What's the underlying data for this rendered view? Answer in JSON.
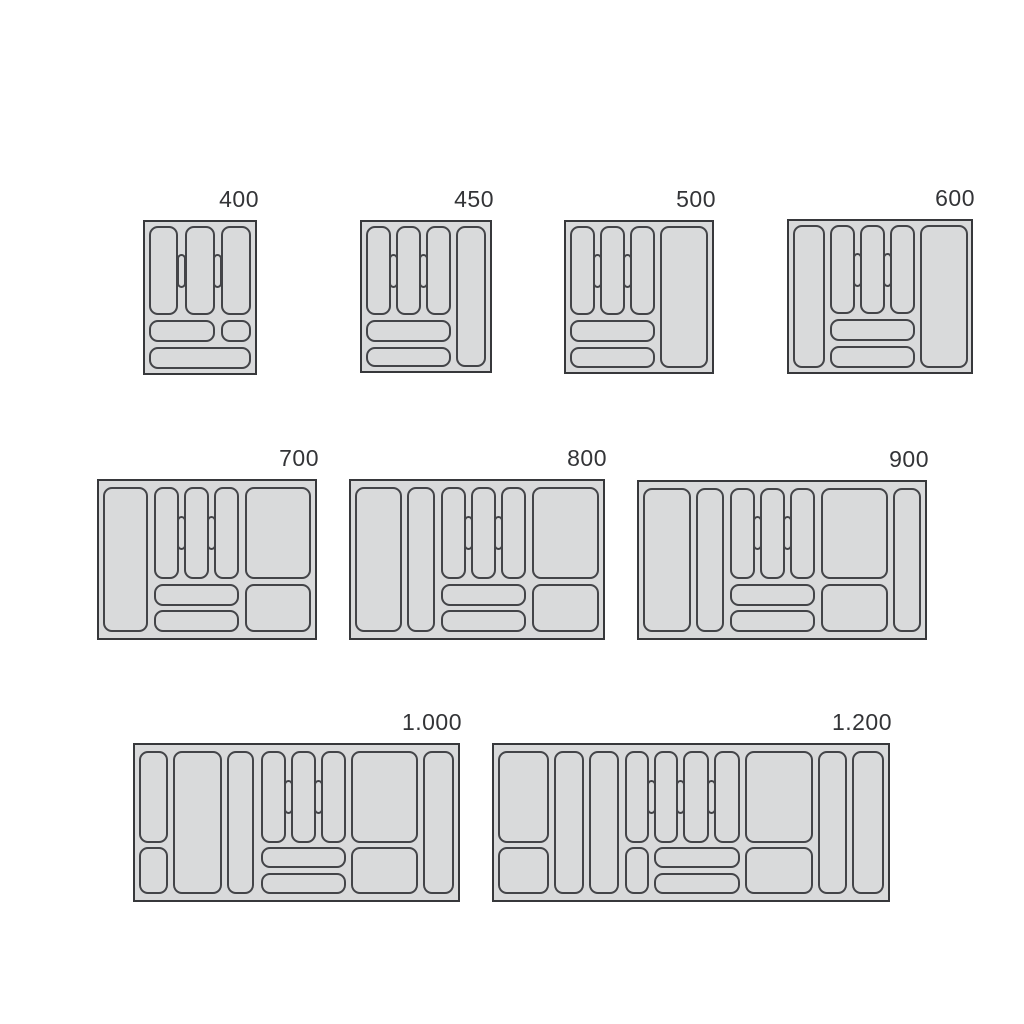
{
  "colors": {
    "background": "#ffffff",
    "tray_fill": "#d9dadb",
    "tray_outline": "#37383b",
    "compartment_outline": "#434448",
    "label_text": "#333437"
  },
  "trays": [
    {
      "label": "400"
    },
    {
      "label": "450"
    },
    {
      "label": "500"
    },
    {
      "label": "600"
    },
    {
      "label": "700"
    },
    {
      "label": "800"
    },
    {
      "label": "900"
    },
    {
      "label": "1.000"
    },
    {
      "label": "1.200"
    }
  ]
}
